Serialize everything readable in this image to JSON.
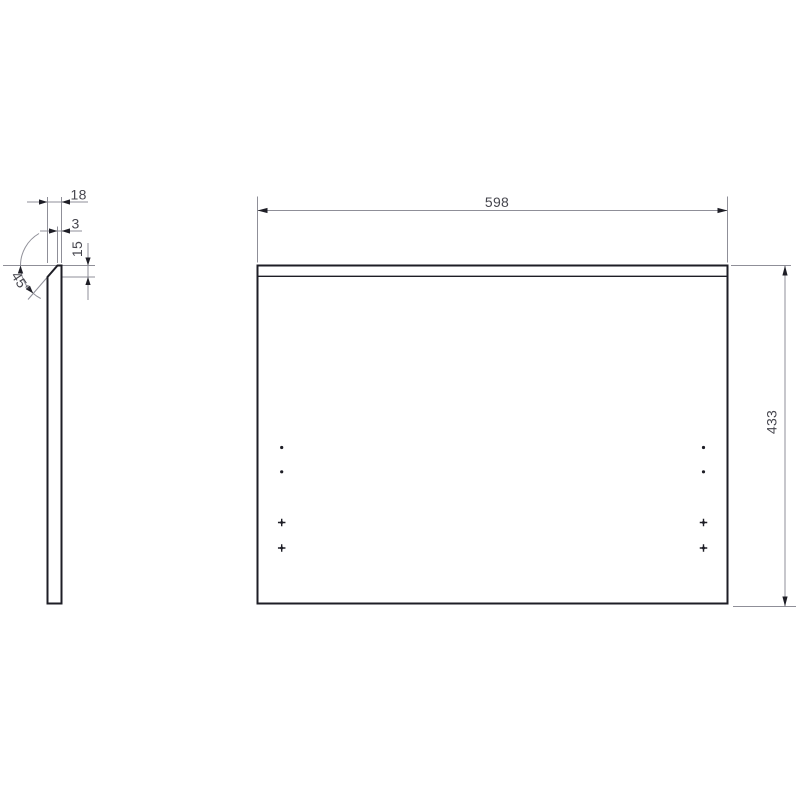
{
  "page": {
    "type": "technical-drawing",
    "background": "#ffffff"
  },
  "colors": {
    "outline": "#1e1e26",
    "dim_lines": "#8f8f98",
    "dim_text": "#46464e"
  },
  "side_view": {
    "description": "side profile of panel with 45-degree chamfered top edge",
    "dims": {
      "thickness": "18",
      "top_edge": "3",
      "chamfer_depth": "15",
      "chamfer_angle": "45°"
    }
  },
  "front_view": {
    "description": "front face of panel with chamfer line and hole markers",
    "dims": {
      "width": "598",
      "height": "433"
    },
    "markers": {
      "columns_x": [
        281.7,
        703.5
      ],
      "dot_rows_y": [
        447.5,
        471.8
      ],
      "cross_rows_y": [
        522.5,
        548.0
      ],
      "dot_radius": 1.6,
      "cross_size": 7.5
    }
  }
}
